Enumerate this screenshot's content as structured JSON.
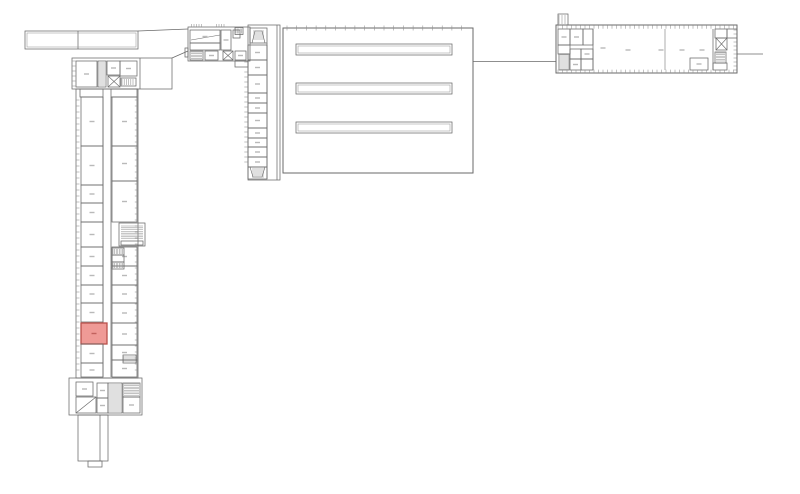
{
  "canvas": {
    "width": 800,
    "height": 494,
    "background": "#ffffff"
  },
  "style": {
    "wall_color": "#6a6a6a",
    "thin_color": "#979797",
    "hatch_color": "#8f8f8f",
    "label_color": "#b9b9b9",
    "highlight_fill": "#ef9a96",
    "highlight_stroke": "#b9504b",
    "highlight_label": "#c2625e"
  },
  "highlighted_room": {
    "x": 81,
    "y": 323,
    "w": 26,
    "h": 21,
    "name": "highlighted-room"
  },
  "plan": {
    "rects": [
      {
        "r": [
          25,
          31,
          113,
          18
        ],
        "n": "north-bridge"
      },
      {
        "r": [
          27,
          33,
          109,
          14
        ],
        "s": "#9a9a9a",
        "t": 0.55,
        "n": "north-bridge-inner"
      },
      {
        "r": [
          72,
          58,
          100,
          31
        ],
        "n": "left-wing-top-section"
      },
      {
        "r": [
          76,
          61,
          21,
          26
        ],
        "lbl": 1
      },
      {
        "r": [
          98,
          61,
          8,
          26
        ],
        "n": "shaft"
      },
      {
        "r": [
          107,
          61,
          13,
          14
        ],
        "lbl": 1
      },
      {
        "r": [
          120,
          61,
          17,
          15
        ],
        "lbl": 1
      },
      {
        "r": [
          108,
          76,
          12,
          11
        ],
        "n": "elevator"
      },
      {
        "r": [
          121,
          78,
          15,
          8
        ],
        "n": "radiator"
      },
      {
        "r": [
          80,
          89,
          23,
          8
        ]
      },
      {
        "r": [
          111,
          89,
          26,
          8
        ]
      },
      {
        "r": [
          76,
          89,
          62,
          289
        ],
        "n": "left-wing"
      },
      {
        "r": [
          81,
          97,
          22,
          49
        ],
        "lbl": 1
      },
      {
        "r": [
          81,
          146,
          22,
          39
        ],
        "lbl": 1
      },
      {
        "r": [
          81,
          185,
          22,
          18
        ],
        "lbl": 1
      },
      {
        "r": [
          81,
          203,
          22,
          19
        ],
        "lbl": 1
      },
      {
        "r": [
          81,
          222,
          22,
          25
        ],
        "lbl": 1
      },
      {
        "r": [
          81,
          247,
          22,
          19
        ],
        "lbl": 1
      },
      {
        "r": [
          81,
          266,
          22,
          19
        ],
        "lbl": 1
      },
      {
        "r": [
          81,
          285,
          22,
          18
        ],
        "lbl": 1
      },
      {
        "r": [
          81,
          303,
          22,
          19
        ],
        "lbl": 1
      },
      {
        "r": [
          81,
          323,
          26,
          21
        ],
        "n": "highlighted-room",
        "f": "#ef9a96",
        "s": "#b9504b",
        "t": 1.3,
        "i": true,
        "lbl": 1,
        "lc": "#c2625e"
      },
      {
        "r": [
          81,
          344,
          22,
          19
        ],
        "lbl": 1
      },
      {
        "r": [
          81,
          363,
          22,
          14
        ],
        "lbl": 1
      },
      {
        "r": [
          112,
          97,
          25,
          49
        ],
        "lbl": 1
      },
      {
        "r": [
          112,
          146,
          25,
          35
        ],
        "lbl": 1
      },
      {
        "r": [
          112,
          181,
          25,
          41
        ],
        "lbl": 1
      },
      {
        "r": [
          112,
          247,
          25,
          19
        ],
        "lbl": 1
      },
      {
        "r": [
          112,
          266,
          25,
          19
        ],
        "lbl": 1
      },
      {
        "r": [
          112,
          285,
          25,
          18
        ],
        "lbl": 1
      },
      {
        "r": [
          112,
          303,
          25,
          20
        ],
        "lbl": 1
      },
      {
        "r": [
          112,
          323,
          25,
          22
        ],
        "lbl": 1
      },
      {
        "r": [
          112,
          345,
          25,
          15
        ],
        "lbl": 1
      },
      {
        "r": [
          112,
          360,
          25,
          17
        ],
        "lbl": 1
      },
      {
        "r": [
          123,
          355,
          13,
          8
        ],
        "n": "cabinet"
      },
      {
        "r": [
          119,
          223,
          26,
          23
        ],
        "n": "stair-core"
      },
      {
        "r": [
          121,
          241,
          22,
          4
        ],
        "n": "landing"
      },
      {
        "r": [
          112,
          248,
          12,
          7
        ],
        "n": "shaft"
      },
      {
        "r": [
          112,
          255,
          12,
          7
        ],
        "n": "shaft"
      },
      {
        "r": [
          112,
          262,
          12,
          7
        ],
        "n": "shaft"
      },
      {
        "r": [
          69,
          378,
          73,
          37
        ],
        "n": "left-wing-south-section"
      },
      {
        "r": [
          76,
          382,
          17,
          14
        ],
        "lbl": 1
      },
      {
        "r": [
          76,
          397,
          20,
          16
        ],
        "n": "ramp-room"
      },
      {
        "r": [
          97,
          383,
          11,
          15
        ],
        "lbl": 1
      },
      {
        "r": [
          97,
          398,
          11,
          15
        ],
        "lbl": 1
      },
      {
        "r": [
          108,
          383,
          14,
          30
        ],
        "n": "stairwell"
      },
      {
        "r": [
          123,
          383,
          17,
          14
        ],
        "n": "shaft"
      },
      {
        "r": [
          123,
          397,
          17,
          16
        ],
        "lbl": 1
      },
      {
        "r": [
          78,
          415,
          30,
          46
        ],
        "n": "south-annex"
      },
      {
        "r": [
          88,
          461,
          14,
          6
        ],
        "n": "annex-step"
      },
      {
        "r": [
          188,
          27,
          62,
          34
        ],
        "n": "north-block"
      },
      {
        "r": [
          190,
          30,
          30,
          13
        ],
        "lbl": 1
      },
      {
        "r": [
          190,
          43,
          30,
          7
        ]
      },
      {
        "r": [
          221,
          30,
          10,
          20
        ],
        "lbl": 1
      },
      {
        "r": [
          233,
          30,
          7,
          8
        ]
      },
      {
        "r": [
          235,
          27.5,
          8,
          7
        ],
        "n": "vent-shaft"
      },
      {
        "r": [
          190,
          51,
          13,
          9
        ],
        "n": "stairwell"
      },
      {
        "r": [
          205,
          51,
          13,
          9
        ],
        "lbl": 1
      },
      {
        "r": [
          223,
          51,
          10,
          9
        ],
        "n": "elevator"
      },
      {
        "r": [
          235,
          51,
          11,
          9
        ],
        "lbl": 1
      },
      {
        "r": [
          235,
          61,
          13,
          6
        ]
      },
      {
        "r": [
          185,
          48,
          3,
          9
        ],
        "n": "bay"
      },
      {
        "r": [
          248,
          25,
          32,
          155
        ],
        "n": "middle-wing"
      },
      {
        "r": [
          250,
          28,
          17,
          15
        ],
        "n": "stairwell"
      },
      {
        "r": [
          248,
          45,
          19,
          15
        ],
        "lbl": 1
      },
      {
        "r": [
          248,
          60,
          19,
          15
        ],
        "lbl": 1
      },
      {
        "r": [
          248,
          75,
          19,
          18
        ],
        "lbl": 1
      },
      {
        "r": [
          248,
          93,
          19,
          10
        ],
        "lbl": 1
      },
      {
        "r": [
          248,
          103,
          19,
          10
        ],
        "lbl": 1
      },
      {
        "r": [
          248,
          113,
          19,
          15
        ],
        "lbl": 1
      },
      {
        "r": [
          248,
          128,
          19,
          10
        ],
        "lbl": 1
      },
      {
        "r": [
          248,
          138,
          19,
          9
        ],
        "lbl": 1
      },
      {
        "r": [
          248,
          147,
          19,
          10
        ],
        "lbl": 1
      },
      {
        "r": [
          248,
          157,
          19,
          10
        ],
        "lbl": 1
      },
      {
        "r": [
          248,
          167,
          19,
          12
        ],
        "n": "stairwell"
      },
      {
        "r": [
          283,
          28,
          190,
          145
        ],
        "t": 1,
        "n": "main-hall"
      },
      {
        "r": [
          296,
          44,
          156,
          11
        ],
        "n": "skylight"
      },
      {
        "r": [
          298,
          46,
          152,
          7
        ],
        "s": "#9a9a9a",
        "t": 0.55,
        "n": "skylight-inner"
      },
      {
        "r": [
          296,
          83,
          156,
          11
        ],
        "n": "skylight"
      },
      {
        "r": [
          298,
          85,
          152,
          7
        ],
        "s": "#9a9a9a",
        "t": 0.55,
        "n": "skylight-inner"
      },
      {
        "r": [
          296,
          122,
          156,
          11
        ],
        "n": "skylight"
      },
      {
        "r": [
          298,
          124,
          152,
          7
        ],
        "s": "#9a9a9a",
        "t": 0.55,
        "n": "skylight-inner"
      },
      {
        "r": [
          556,
          25,
          181,
          48
        ],
        "t": 1,
        "n": "east-wing"
      },
      {
        "r": [
          558,
          14,
          10,
          11
        ],
        "n": "canopy"
      },
      {
        "r": [
          558,
          29,
          12,
          16
        ],
        "lbl": 1
      },
      {
        "r": [
          570,
          29,
          13,
          16
        ],
        "lbl": 1
      },
      {
        "r": [
          583,
          29,
          10,
          16
        ]
      },
      {
        "r": [
          558,
          45,
          12,
          9
        ]
      },
      {
        "r": [
          559,
          54,
          10,
          16
        ],
        "n": "stairwell"
      },
      {
        "r": [
          570,
          49,
          11,
          10
        ]
      },
      {
        "r": [
          581,
          49,
          12,
          10
        ],
        "lbl": 1
      },
      {
        "r": [
          570,
          59,
          11,
          11
        ],
        "lbl": 1
      },
      {
        "r": [
          581,
          59,
          12,
          11
        ]
      },
      {
        "r": [
          690,
          58,
          18,
          12
        ],
        "lbl": 1
      },
      {
        "r": [
          716,
          38,
          11,
          12
        ],
        "n": "elevator"
      },
      {
        "r": [
          715,
          29,
          12,
          9
        ]
      },
      {
        "r": [
          727,
          29,
          10,
          9
        ]
      },
      {
        "r": [
          715,
          52,
          11,
          11
        ],
        "n": "shaft"
      },
      {
        "r": [
          713,
          63,
          14,
          7
        ]
      }
    ],
    "lines": [
      {
        "l": [
          78,
          31,
          78,
          49
        ]
      },
      {
        "l": [
          138,
          31,
          188,
          29
        ],
        "n": "link-line"
      },
      {
        "l": [
          172,
          58,
          188,
          51
        ],
        "n": "link-line"
      },
      {
        "l": [
          191,
          40,
          220,
          35
        ],
        "t": 0.55
      },
      {
        "l": [
          140,
          58,
          140,
          89
        ]
      },
      {
        "l": [
          103,
          97,
          103,
          377
        ]
      },
      {
        "l": [
          111,
          97,
          111,
          377
        ]
      },
      {
        "l": [
          100,
          415,
          100,
          461
        ]
      },
      {
        "l": [
          76,
          413,
          96,
          397
        ],
        "n": "ramp-line"
      },
      {
        "l": [
          267,
          43,
          267,
          179
        ]
      },
      {
        "l": [
          277,
          25,
          277,
          180
        ]
      },
      {
        "l": [
          473,
          61.5,
          556,
          61.5
        ],
        "n": "site-line"
      },
      {
        "l": [
          737,
          54,
          763,
          54
        ],
        "n": "site-line"
      },
      {
        "l": [
          593,
          29,
          593,
          70
        ]
      },
      {
        "l": [
          665,
          29,
          665,
          70
        ],
        "t": 0.55
      },
      {
        "l": [
          713,
          29,
          713,
          70
        ]
      }
    ],
    "hatches": [
      {
        "h": [
          99,
          63,
          6,
          22
        ],
        "d": "h",
        "g": 2,
        "n": "stair-hatch"
      },
      {
        "h": [
          122,
          79,
          13,
          6
        ],
        "d": "v",
        "g": 2.2,
        "n": "radiator-hatch"
      },
      {
        "h": [
          76.5,
          100,
          3,
          274
        ],
        "d": "h",
        "g": 6,
        "n": "window-band"
      },
      {
        "h": [
          134.8,
          100,
          3,
          274
        ],
        "d": "h",
        "g": 6,
        "n": "window-band"
      },
      {
        "h": [
          72.5,
          61,
          3,
          25
        ],
        "d": "h",
        "g": 5,
        "n": "window-band"
      },
      {
        "h": [
          121,
          226,
          22,
          14
        ],
        "d": "h",
        "g": 1.8,
        "n": "stair-hatch"
      },
      {
        "h": [
          113,
          249,
          10,
          5
        ],
        "d": "v",
        "g": 1.6,
        "n": "shaft-hatch"
      },
      {
        "h": [
          113,
          263,
          10,
          5
        ],
        "d": "v",
        "g": 1.6,
        "n": "shaft-hatch"
      },
      {
        "h": [
          109,
          385,
          12,
          26
        ],
        "d": "h",
        "g": 2,
        "n": "stair-hatch"
      },
      {
        "h": [
          124,
          384,
          15,
          12
        ],
        "d": "h",
        "g": 1.6,
        "n": "shaft-hatch"
      },
      {
        "h": [
          124,
          356,
          11,
          6
        ],
        "d": "v",
        "g": 2,
        "n": "cabinet-hatch"
      },
      {
        "h": [
          191,
          52,
          11,
          7
        ],
        "d": "h",
        "g": 1.6,
        "n": "stair-hatch"
      },
      {
        "h": [
          236,
          28.5,
          6,
          5
        ],
        "d": "v",
        "g": 1.4,
        "n": "vent-hatch"
      },
      {
        "h": [
          191.5,
          24,
          10,
          3
        ],
        "d": "v",
        "g": 2.5,
        "n": "tick-row"
      },
      {
        "h": [
          216.5,
          24,
          8,
          3
        ],
        "d": "v",
        "g": 2.5,
        "n": "tick-row"
      },
      {
        "h": [
          253,
          31,
          11,
          9
        ],
        "d": "h",
        "g": 2,
        "n": "stair-hatch"
      },
      {
        "h": [
          252,
          169,
          12,
          8
        ],
        "d": "h",
        "g": 2,
        "n": "stair-hatch"
      },
      {
        "h": [
          244.3,
          62,
          3.4,
          104
        ],
        "d": "h",
        "g": 5,
        "n": "window-band"
      },
      {
        "h": [
          287,
          25.5,
          184,
          5
        ],
        "d": "v",
        "g": 9.7,
        "n": "column-ticks"
      },
      {
        "h": [
          558,
          25.3,
          177,
          3.4
        ],
        "d": "v",
        "g": 4.5,
        "n": "window-band"
      },
      {
        "h": [
          558,
          69.6,
          177,
          3.4
        ],
        "d": "v",
        "g": 4.5,
        "n": "window-band"
      },
      {
        "h": [
          559,
          15,
          8,
          9
        ],
        "d": "v",
        "g": 3,
        "n": "canopy-hatch"
      },
      {
        "h": [
          560,
          55,
          8,
          14
        ],
        "d": "h",
        "g": 2,
        "n": "stair-hatch"
      },
      {
        "h": [
          716,
          53,
          9,
          9
        ],
        "d": "h",
        "g": 1.6,
        "n": "shaft-hatch"
      },
      {
        "h": [
          733.5,
          30,
          3,
          40
        ],
        "d": "h",
        "g": 4,
        "n": "window-band"
      }
    ],
    "crosses": [
      {
        "c": [
          108,
          76,
          12,
          11
        ],
        "n": "elevator-cross"
      },
      {
        "c": [
          223,
          51,
          10,
          9
        ],
        "n": "elevator-cross"
      },
      {
        "c": [
          716,
          38,
          11,
          12
        ],
        "n": "elevator-cross"
      }
    ],
    "polys": [
      {
        "p": [
          [
            252,
            43
          ],
          [
            255,
            31
          ],
          [
            262,
            31
          ],
          [
            265,
            43
          ]
        ],
        "n": "stair-flight"
      },
      {
        "p": [
          [
            250,
            167
          ],
          [
            253,
            177
          ],
          [
            262,
            177
          ],
          [
            265,
            167
          ]
        ],
        "n": "stair-flight"
      }
    ],
    "labels": [
      {
        "x": 603,
        "y": 48
      },
      {
        "x": 628,
        "y": 50
      },
      {
        "x": 661,
        "y": 50
      },
      {
        "x": 682,
        "y": 50
      },
      {
        "x": 702,
        "y": 50
      }
    ]
  }
}
